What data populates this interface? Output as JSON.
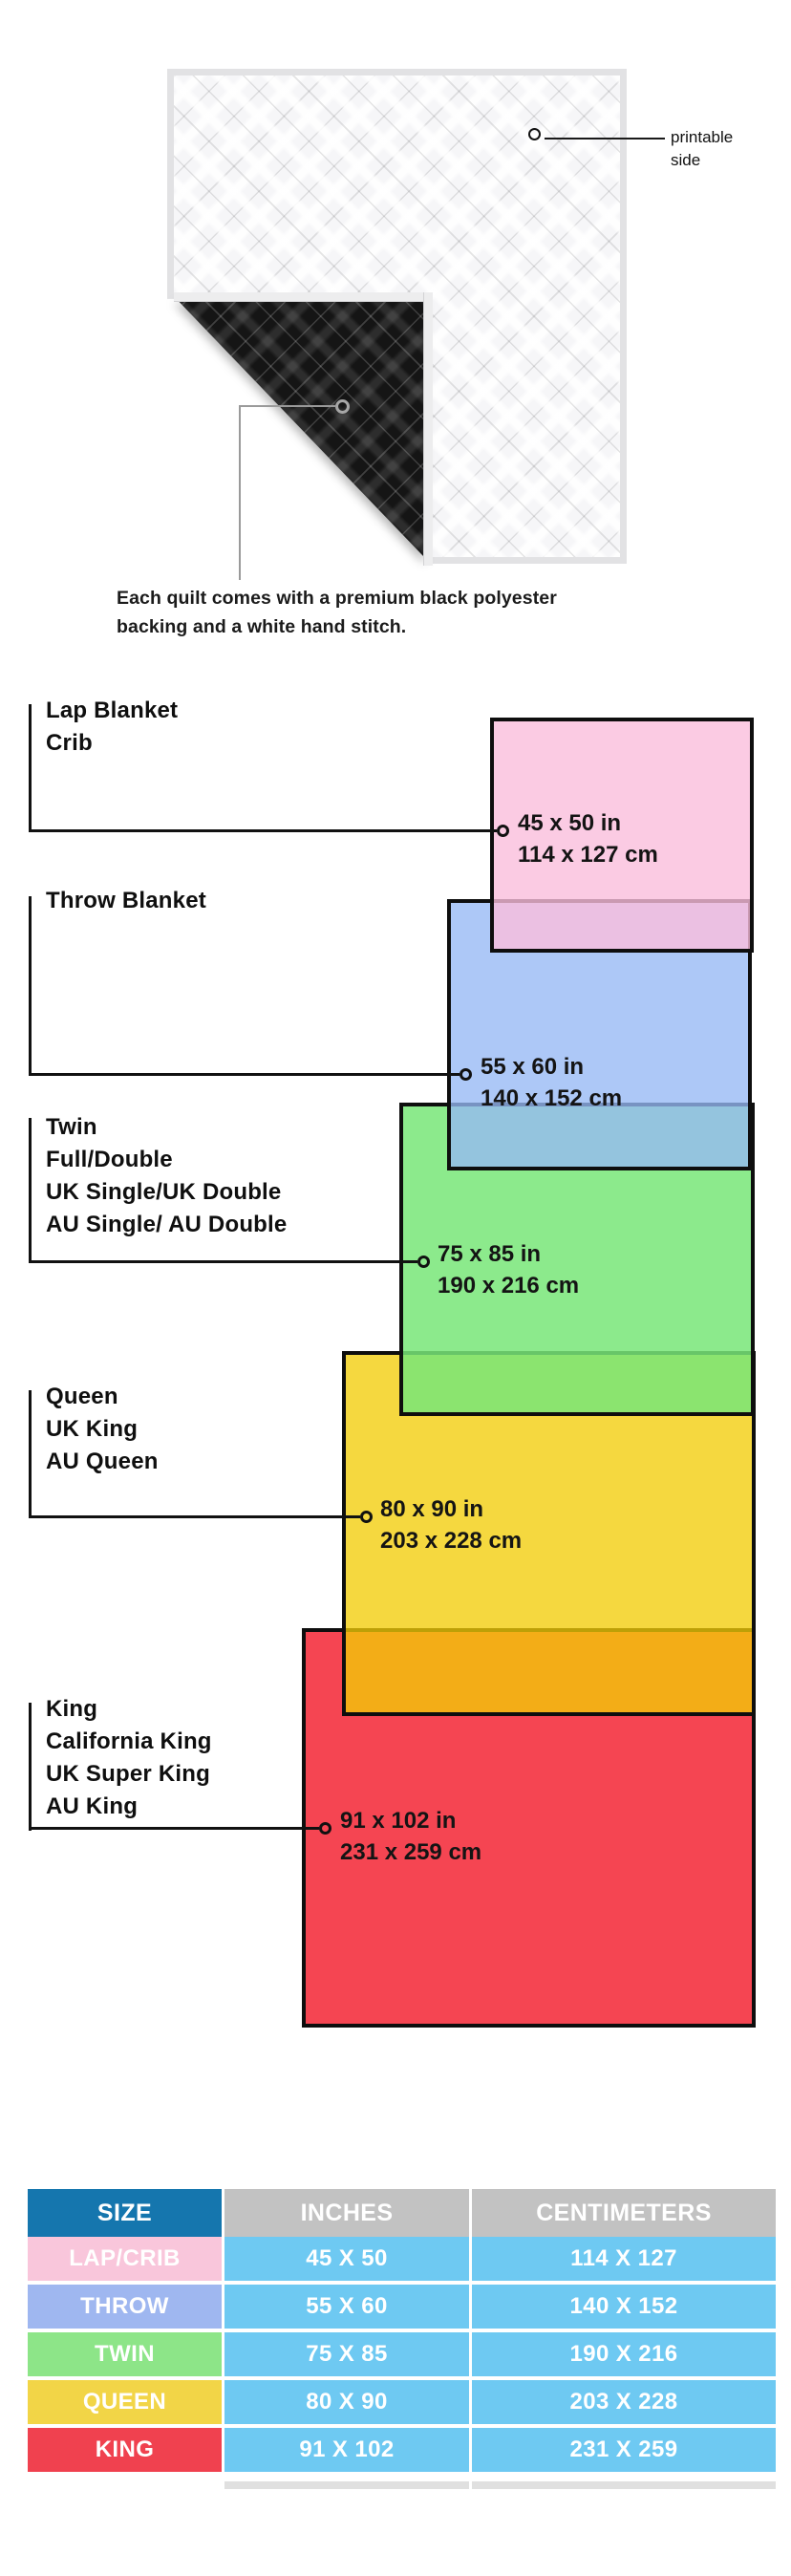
{
  "figure": {
    "printable_label_line1": "printable",
    "printable_label_line2": "side",
    "caption_line1": "Each quilt comes with a premium black polyester",
    "caption_line2": "backing and a white hand stitch."
  },
  "diagram": {
    "sizes": [
      {
        "name": "lap-crib",
        "labels": [
          "Lap Blanket",
          "Crib"
        ],
        "inches": "45 x 50 in",
        "cm": "114 x 127 cm",
        "fill": "#FBC9E0"
      },
      {
        "name": "throw",
        "labels": [
          "Throw Blanket"
        ],
        "inches": "55 x 60 in",
        "cm": "140 x 152 cm",
        "fill": "#A9C3F7"
      },
      {
        "name": "twin",
        "labels": [
          "Twin",
          "Full/Double",
          "UK Single/UK Double",
          "AU Single/ AU Double"
        ],
        "inches": "75 x 85 in",
        "cm": "190 x 216 cm",
        "fill": "#96EC96"
      },
      {
        "name": "queen",
        "labels": [
          "Queen",
          "UK King",
          "AU Queen"
        ],
        "inches": "80 x 90 in",
        "cm": "203 x 228 cm",
        "fill": "#F5D83F"
      },
      {
        "name": "king",
        "labels": [
          "King",
          "California King",
          "UK Super King",
          "AU King"
        ],
        "inches": "91 x 102 in",
        "cm": "231 x 259 cm",
        "fill": "#F54552"
      }
    ],
    "overlap_colors": {
      "pink_over_blue": "#E9C0E1",
      "blue_over_green": "#94C4DE",
      "green_over_yellow": "#8BE46F",
      "yellow_over_red": "#F3AD17"
    }
  },
  "table": {
    "headers": [
      "SIZE",
      "INCHES",
      "CENTIMETERS"
    ],
    "header_colors": {
      "size": "#1576AE",
      "measures": "#C2C2C2"
    },
    "value_cell_color": "#6EC9F2",
    "rows": [
      {
        "size": "LAP/CRIB",
        "inches": "45 X 50",
        "cm": "114 X 127",
        "color": "#F9C6DB"
      },
      {
        "size": "THROW",
        "inches": "55 X 60",
        "cm": "140 X 152",
        "color": "#9FB7F0"
      },
      {
        "size": "TWIN",
        "inches": "75 X 85",
        "cm": "190 X 216",
        "color": "#8DE588"
      },
      {
        "size": "QUEEN",
        "inches": "80 X 90",
        "cm": "203 X 228",
        "color": "#F2D547"
      },
      {
        "size": "KING",
        "inches": "91 X 102",
        "cm": "231 X 259",
        "color": "#F0414F"
      }
    ]
  }
}
